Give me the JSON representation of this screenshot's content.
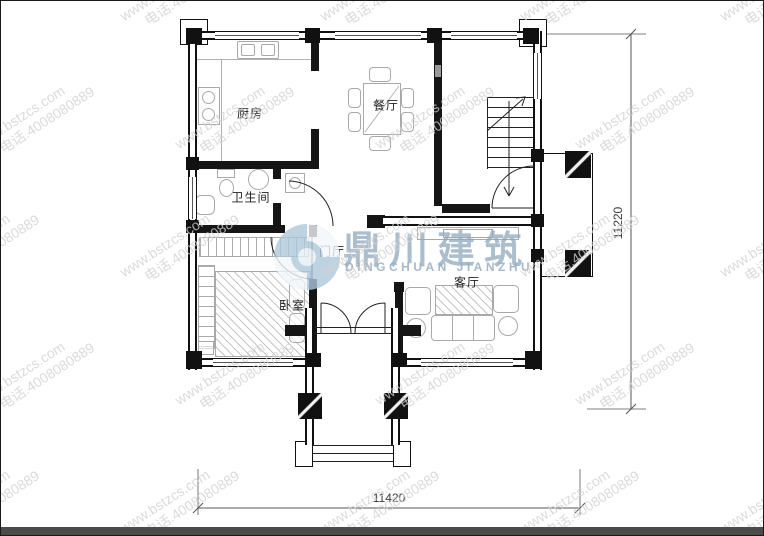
{
  "watermark": {
    "line1": "www.bstzcs.com",
    "line2": "电话.4008080889"
  },
  "logo": {
    "cn": "鼎川建筑",
    "en": "DINGCHUAN JIANZHU"
  },
  "rooms": {
    "kitchen": "厨房",
    "dining": "餐厅",
    "bathroom": "卫生间",
    "foyer": "门厅",
    "bedroom": "卧室",
    "living": "客厅"
  },
  "dimensions": {
    "height": "11220",
    "width": "11420"
  },
  "colors": {
    "wall": "#151515",
    "logo_blue": "#9fb8cb",
    "watermark_gray": "#d2d2d2",
    "furniture_gray": "#a9a9a9"
  }
}
